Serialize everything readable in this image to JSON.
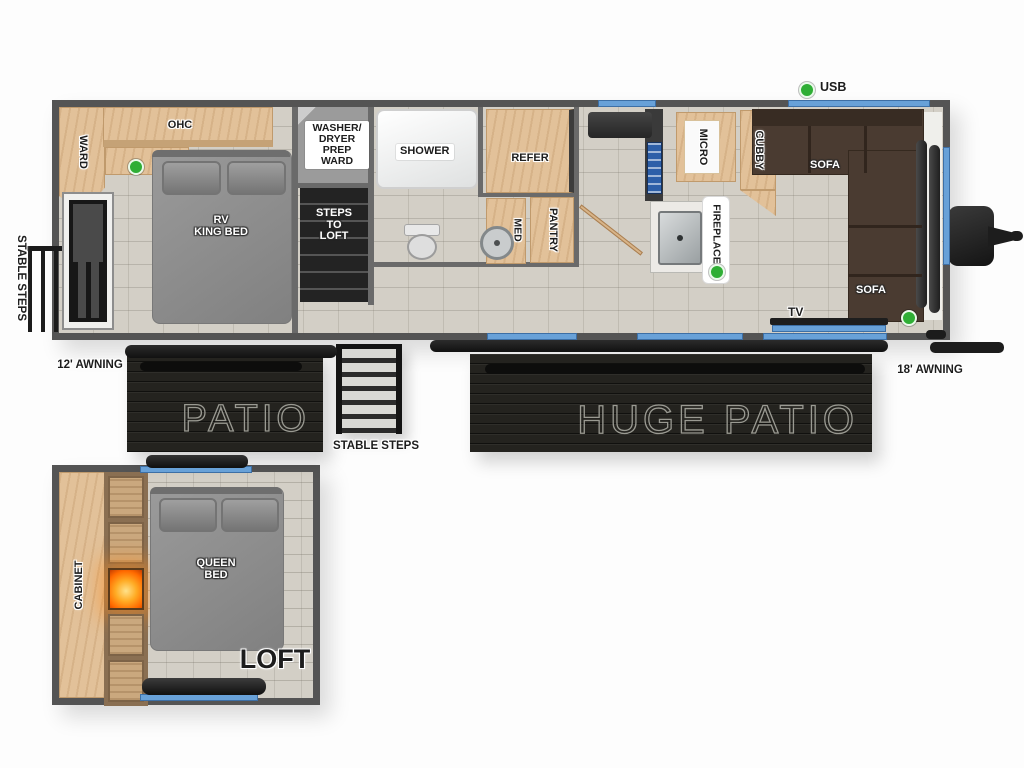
{
  "main": {
    "bedroom": {
      "ward": "WARD",
      "ohc": "OHC",
      "bed": "RV\nKING BED"
    },
    "midship": {
      "washer": "WASHER/\nDRYER\nPREP\nWARD",
      "steps_to_loft": "STEPS\nTO\nLOFT",
      "shower": "SHOWER",
      "med": "MED",
      "pantry": "PANTRY",
      "refer": "REFER"
    },
    "kitchen_living": {
      "micro": "MICRO",
      "cubby": "CUBBY",
      "fireplace": "FIREPLACE",
      "sofa_top": "SOFA",
      "sofa_right": "SOFA",
      "tv": "TV",
      "usb": "USB"
    }
  },
  "exterior": {
    "stable_steps_left": "STABLE STEPS",
    "awning_left": "12' AWNING",
    "patio": "PATIO",
    "stable_steps_bottom": "STABLE STEPS",
    "huge_patio": "HUGE PATIO",
    "awning_right": "18' AWNING"
  },
  "loft": {
    "cabinet": "CABINET",
    "bed": "QUEEN\nBED",
    "title": "LOFT"
  },
  "colors": {
    "window_blue": "#68a1d8",
    "indicator_green": "#2fae35",
    "wood": "#e2c199",
    "sofa_brown": "#4a3b31",
    "patio_black": "#24231f"
  }
}
